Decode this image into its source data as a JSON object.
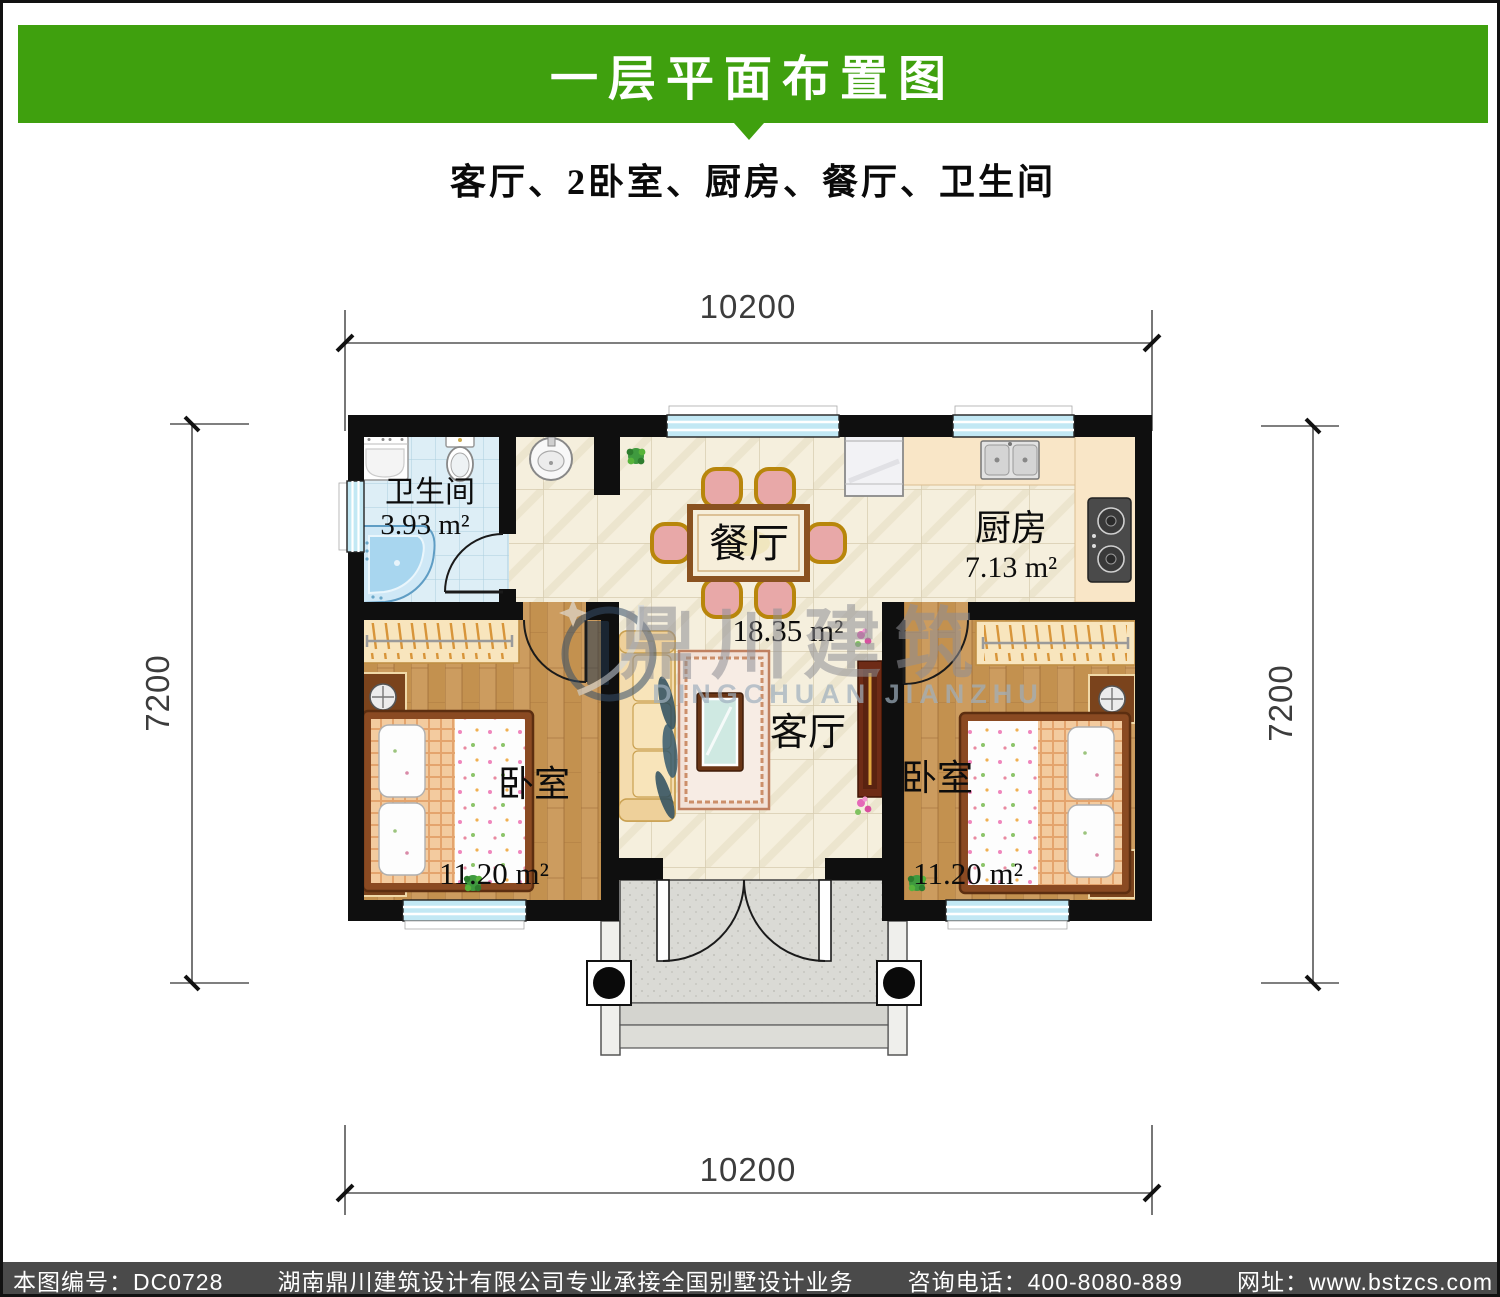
{
  "header": {
    "title": "一层平面布置图",
    "subtitle": "客厅、2卧室、厨房、餐厅、卫生间",
    "banner_color": "#3FA00E"
  },
  "footer": {
    "bg": "#4A4A4A",
    "items": [
      "本图编号：DC0728",
      "湖南鼎川建筑设计有限公司专业承接全国别墅设计业务",
      "咨询电话：400-8080-889",
      "网址：www.bstzcs.com"
    ]
  },
  "floorplan": {
    "dimensions": {
      "top": "10200",
      "bottom": "10200",
      "left": "7200",
      "right": "7200"
    },
    "rooms": [
      {
        "id": "bathroom",
        "name": "卫生间",
        "area": "3.93 m²"
      },
      {
        "id": "dining",
        "name": "餐厅",
        "area": ""
      },
      {
        "id": "kitchen",
        "name": "厨房",
        "area": "7.13 m²"
      },
      {
        "id": "living",
        "name": "客厅",
        "area": "18.35 m²"
      },
      {
        "id": "bedroom-left",
        "name": "卧室",
        "area": "11.20 m²"
      },
      {
        "id": "bedroom-right",
        "name": "卧室",
        "area": "11.20 m²"
      }
    ],
    "watermark": {
      "cn": "鼎川建筑",
      "en": "DINGCHUAN JIANZHU"
    }
  }
}
